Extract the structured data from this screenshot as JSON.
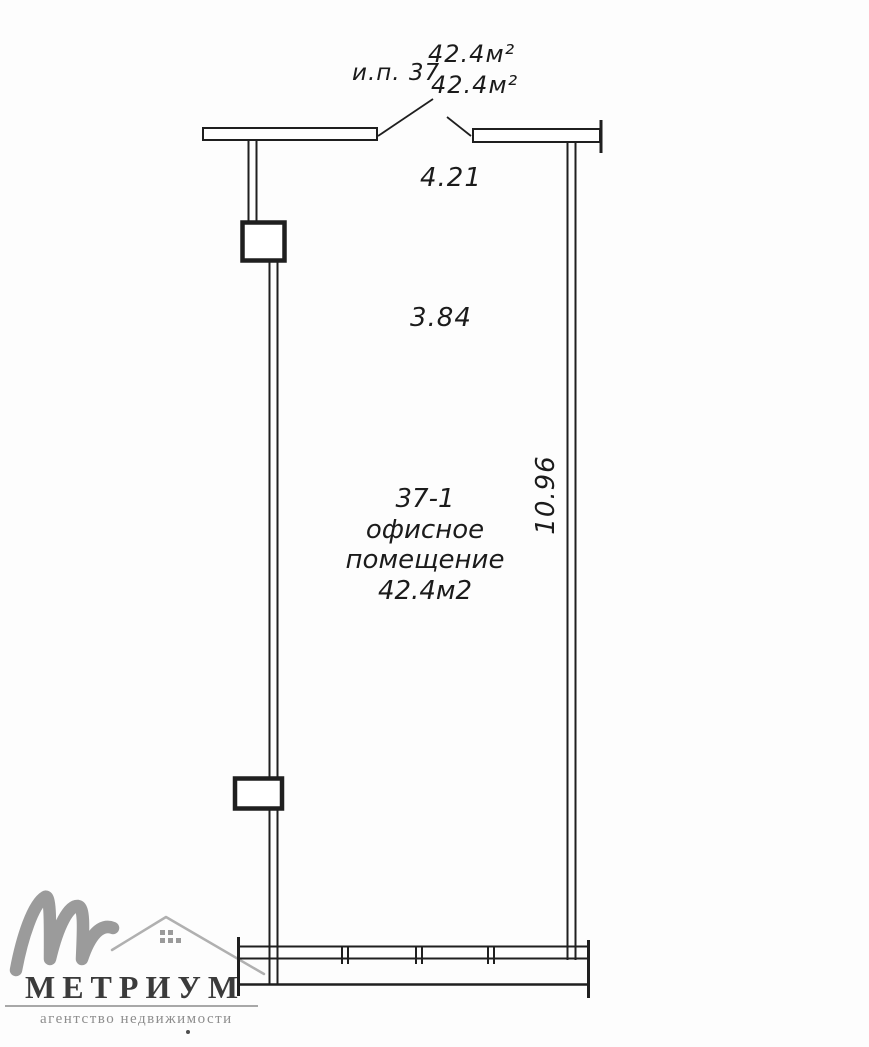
{
  "colors": {
    "ink": "#1f1f1f",
    "paper": "#fdfdfd",
    "logo_monogram": "#9b9b9b",
    "logo_house": "#b0b0b0",
    "logo_brand": "#3b3b3b",
    "logo_tagline": "#8d8d8d"
  },
  "annotations": {
    "unit_label": "и.п. 37",
    "area_line1": "42.4м²",
    "area_line2": "42.4м²",
    "dim_top_width": "4.21",
    "dim_inner_width": "3.84",
    "dim_right_height": "10.96"
  },
  "room": {
    "number": "37-1",
    "type_line1": "офисное",
    "type_line2": "помещение",
    "area": "42.4м2"
  },
  "logo": {
    "brand": "МЕТРИУМ",
    "tagline": "агентство недвижимости",
    "monogram_icon": "script-m-icon",
    "house_icon": "house-roof-icon"
  }
}
